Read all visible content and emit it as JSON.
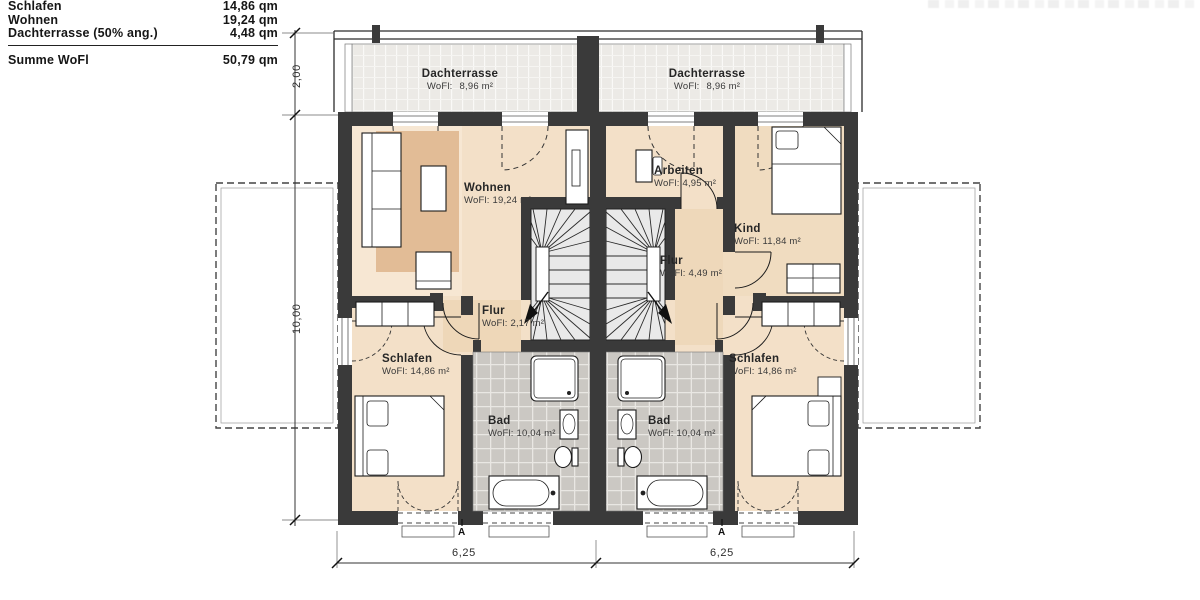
{
  "legend": {
    "rows": [
      {
        "label": "Schlafen",
        "value": "14,86 qm"
      },
      {
        "label": "Wohnen",
        "value": "19,24 qm"
      },
      {
        "label": "Dachterrasse (50% ang.)",
        "value": "4,48 qm"
      }
    ],
    "total": {
      "label": "Summe WoFl",
      "value": "50,79 qm"
    }
  },
  "rooms": {
    "terrace_left": {
      "name": "Dachterrasse",
      "area_label": "WoFl:",
      "area": "8,96 m²"
    },
    "terrace_right": {
      "name": "Dachterrasse",
      "area_label": "WoFl:",
      "area": "8,96 m²"
    },
    "wohnen": {
      "name": "Wohnen",
      "area_label": "WoFl:",
      "area": "19,24 m²"
    },
    "arbeiten": {
      "name": "Arbeiten",
      "area_label": "WoFl:",
      "area": "4,95 m²"
    },
    "kind": {
      "name": "Kind",
      "area_label": "WoFl:",
      "area": "11,84 m²"
    },
    "flur_left": {
      "name": "Flur",
      "area_label": "WoFl:",
      "area": "2,17 m²"
    },
    "flur_right": {
      "name": "Flur",
      "area_label": "WoFl:",
      "area": "4,49 m²"
    },
    "schlafen_left": {
      "name": "Schlafen",
      "area_label": "WoFl:",
      "area": "14,86 m²"
    },
    "schlafen_right": {
      "name": "Schlafen",
      "area_label": "WoFl:",
      "area": "14,86 m²"
    },
    "bad_left": {
      "name": "Bad",
      "area_label": "WoFl:",
      "area": "10,04 m²"
    },
    "bad_right": {
      "name": "Bad",
      "area_label": "WoFl:",
      "area": "10,04 m²"
    }
  },
  "dimensions": {
    "terrace_depth": "2,00",
    "house_depth": "10,00",
    "width_left": "6,25",
    "width_right": "6,25"
  },
  "section_markers": {
    "left": "A",
    "right": "A"
  },
  "colors": {
    "wall": "#3a3a3a",
    "floor_beige": "#f3e0c8",
    "accent_beige": "#e2bc96",
    "tile_gray": "#cbc8c3",
    "terrace_gray": "#eceae6"
  }
}
